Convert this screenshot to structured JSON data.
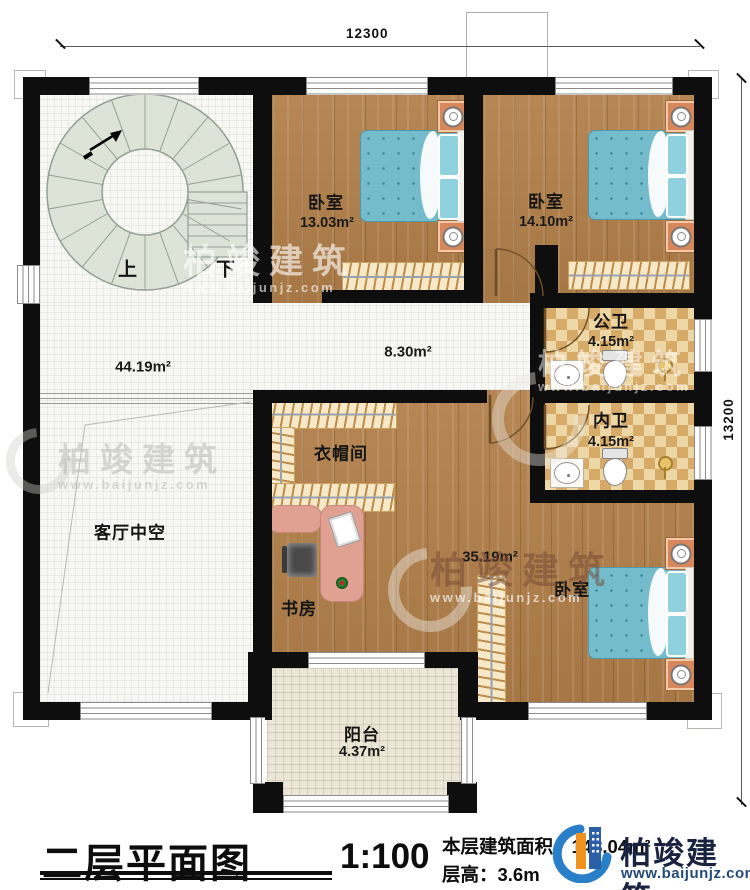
{
  "dims": {
    "width": "12300",
    "height": "13200"
  },
  "stairs": {
    "up": "上",
    "down": "下"
  },
  "rooms": {
    "bedroom_top_left": {
      "name": "卧室",
      "area": "13.03m²"
    },
    "bedroom_top_right": {
      "name": "卧室",
      "area": "14.10m²"
    },
    "stair_hall": {
      "area": "44.19m²"
    },
    "corridor": {
      "area": "8.30m²"
    },
    "public_bath": {
      "name": "公卫",
      "area": "4.15m²"
    },
    "inner_bath": {
      "name": "内卫",
      "area": "4.15m²"
    },
    "living_void": {
      "name": "客厅中空"
    },
    "cloakroom": {
      "name": "衣帽间"
    },
    "study": {
      "name": "书房"
    },
    "master_area": {
      "area": "35.19m²"
    },
    "bedroom_master": {
      "name": "卧室"
    },
    "balcony": {
      "name": "阳台",
      "area": "4.37m²"
    }
  },
  "title_block": {
    "title": "二层平面图",
    "scale": "1:100",
    "area_line": "本层建筑面积：148.04m²",
    "height_line": "层高：3.6m"
  },
  "brand": {
    "name": "柏竣建筑",
    "site": "www.baijunjz.com"
  },
  "watermark": {
    "name": "柏竣建筑",
    "site": "www.baijunjz.com"
  },
  "colors": {
    "wall": "#0e0e0e",
    "wood": "#b2804a",
    "tile": "#f7f7f4",
    "checker_light": "#eed7a6",
    "checker_dark": "#d7aa68",
    "bed": "#74bccb",
    "logo_blue": "#2a7fc9",
    "logo_orange": "#f09220"
  }
}
